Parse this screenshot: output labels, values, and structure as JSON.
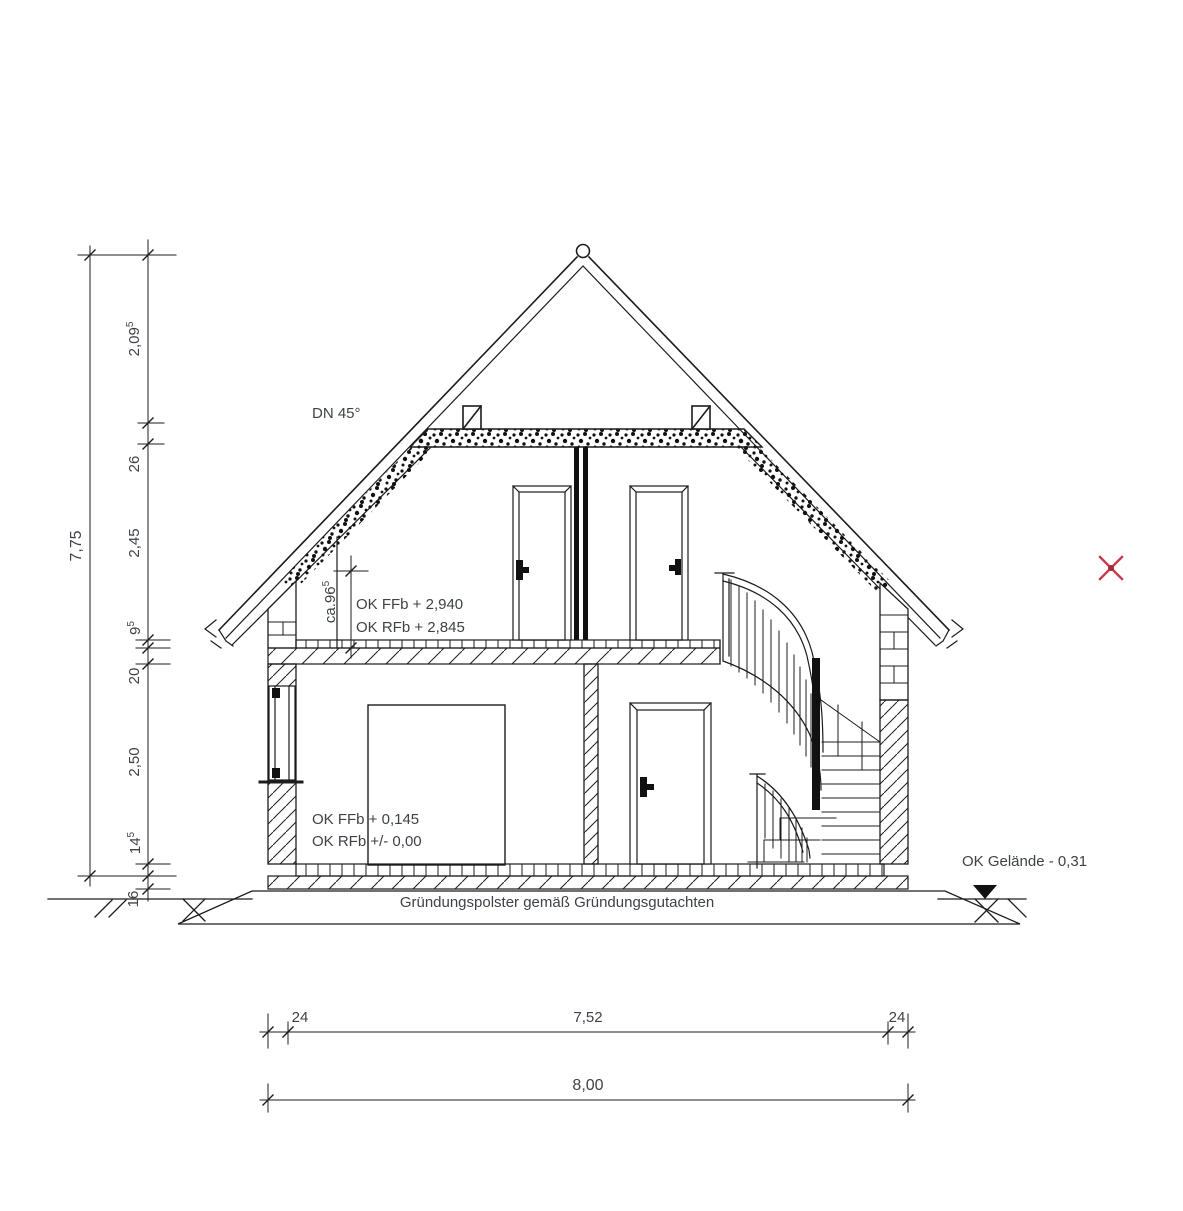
{
  "annotations": {
    "roof_pitch": "DN 45°",
    "knee_height": {
      "value": "ca.96",
      "sup": "5"
    },
    "upper_floor_levels": {
      "ffb": "OK FFb + 2,940",
      "rfb": "OK RFb + 2,845"
    },
    "ground_floor_levels": {
      "ffb": "OK FFb + 0,145",
      "rfb": "OK RFb +/- 0,00"
    },
    "foundation_note": "Gründungspolster gemäß Gründungsgutachten",
    "terrain_level": "OK Gelände  - 0,31"
  },
  "dimensions": {
    "vertical": {
      "total": "7,75",
      "segments": [
        {
          "value": "2,09",
          "sup": "5"
        },
        {
          "value": "26",
          "sup": ""
        },
        {
          "value": "2,45",
          "sup": ""
        },
        {
          "value": "9",
          "sup": "5"
        },
        {
          "value": "20",
          "sup": ""
        },
        {
          "value": "2,50",
          "sup": ""
        },
        {
          "value": "14",
          "sup": "5"
        },
        {
          "value": "16",
          "sup": ""
        }
      ]
    },
    "horizontal": {
      "total": "8,00",
      "segments": [
        {
          "value": "24"
        },
        {
          "value": "7,52"
        },
        {
          "value": "24"
        }
      ]
    }
  },
  "colors": {
    "line": "#1c1c1c",
    "text": "#3e4248",
    "marker_red": "#c63c4f"
  }
}
